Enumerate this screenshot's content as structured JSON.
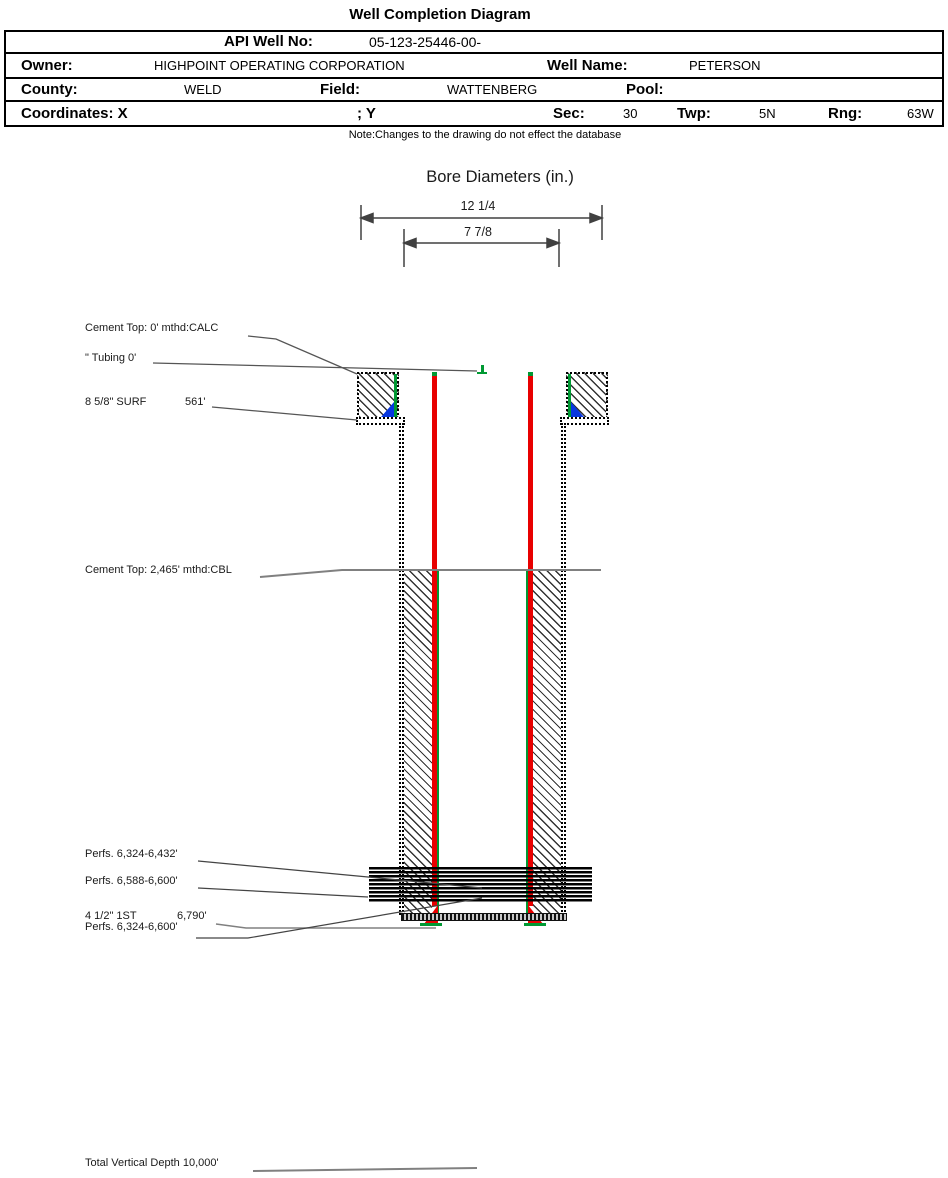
{
  "title": "Well Completion Diagram",
  "note": "Note:Changes to the drawing do not effect the database",
  "header_table": {
    "api_label": "API Well No:",
    "api_value": "05-123-25446-00-",
    "owner_label": "Owner:",
    "owner_value": "HIGHPOINT OPERATING CORPORATION",
    "well_name_label": "Well Name:",
    "well_name_value": "PETERSON",
    "county_label": "County:",
    "county_value": "WELD",
    "field_label": "Field:",
    "field_value": "WATTENBERG",
    "pool_label": "Pool:",
    "pool_value": "",
    "coordinates_label": "Coordinates: X",
    "coordinates_y_label": "; Y",
    "sec_label": "Sec:",
    "sec_value": "30",
    "twp_label": "Twp:",
    "twp_value": "5N",
    "rng_label": "Rng:",
    "rng_value": "63W"
  },
  "bore_diameters": {
    "title": "Bore Diameters (in.)",
    "outer_label": "12 1/4",
    "inner_label": "7 7/8"
  },
  "annotations": {
    "cement_top_surface": "Cement Top: 0' mthd:CALC",
    "tubing": "\" Tubing 0'",
    "surface_casing": "8 5/8\" SURF",
    "surface_casing_depth": "561'",
    "cement_top_production": "Cement Top: 2,465' mthd:CBL",
    "perfs_upper": "Perfs. 6,324-6,432'",
    "perfs_middle": "Perfs. 6,588-6,600'",
    "production_casing": "4 1/2\" 1ST",
    "production_casing_depth": "6,790'",
    "perfs_overall": "Perfs. 6,324-6,600'",
    "tvd": "Total Vertical Depth 10,000'"
  },
  "colors": {
    "casing_red": "#e80000",
    "casing_green": "#009933",
    "cement_shoe_blue": "#0837e0",
    "leader_gray": "#808080",
    "line_black": "#404040"
  }
}
